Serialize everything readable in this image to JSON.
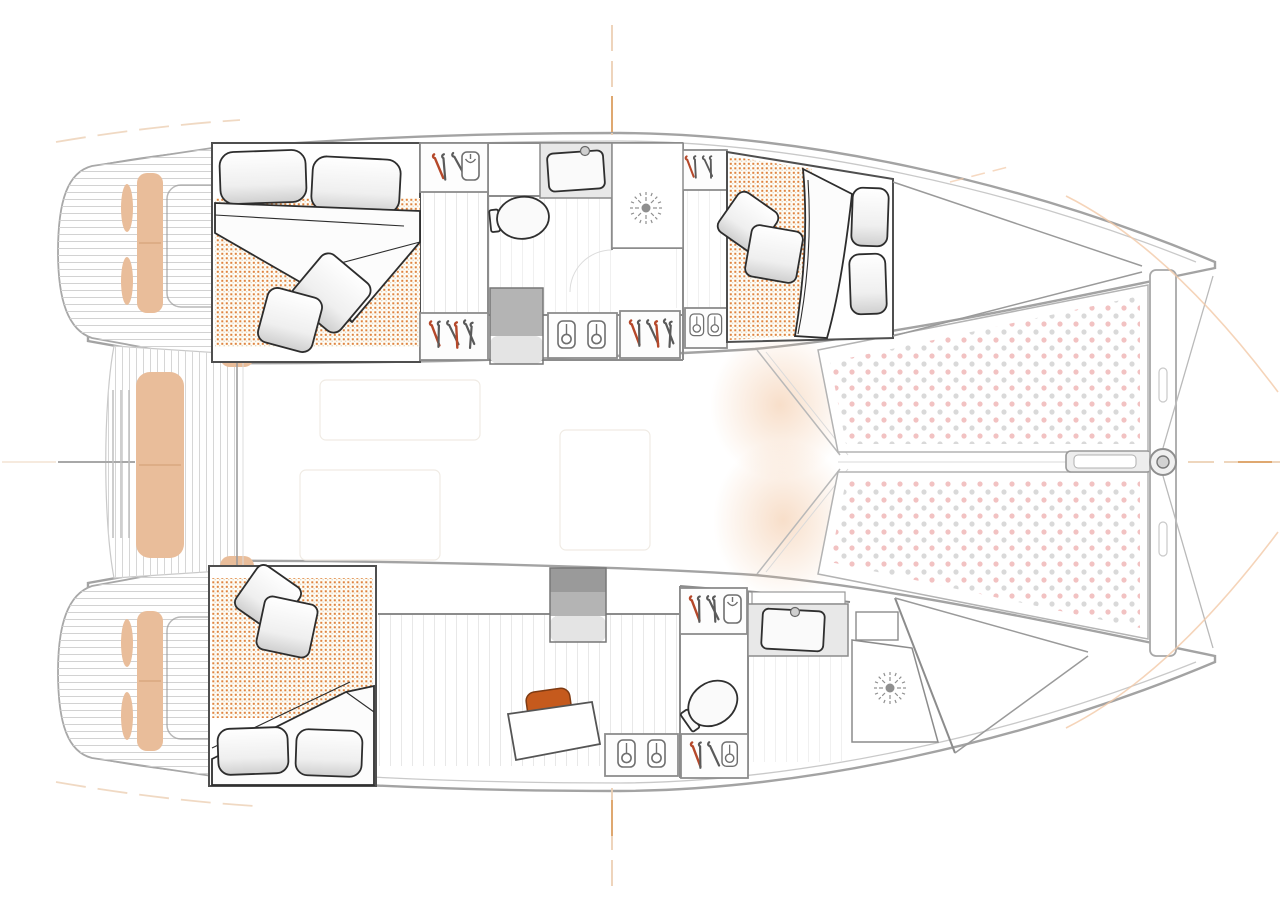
{
  "diagram": {
    "type": "floorplan",
    "subject": "catamaran interior layout, plan view",
    "orientation": {
      "bow": "right",
      "stern": "left"
    },
    "hulls": [
      {
        "name": "upper-hull",
        "rooms": [
          "aft double cabin",
          "head with shower",
          "forward double cabin",
          "forepeak"
        ]
      },
      {
        "name": "lower-hull",
        "rooms": [
          "aft double cabin",
          "desk area",
          "head with shower",
          "forepeak"
        ]
      }
    ],
    "shared_areas": [
      "port and starboard swim platforms with bench seats",
      "aft cockpit with long bench",
      "saloon (faint)",
      "twin bow trampolines",
      "forward crossbeam with bowsprit"
    ],
    "fixture_counts": {
      "double_beds": 3,
      "toilets": 2,
      "washbasins": 2,
      "showers": 2,
      "wardrobes": 7,
      "companionway_steps": 2,
      "desk_chairs": 1
    }
  },
  "colors": {
    "background": "#ffffff",
    "hull_outline": "#a3a3a3",
    "inner_line": "#c9c9c9",
    "wall": "#8c8c8c",
    "furniture_outline": "#2d2d2d",
    "bed_frame": "#4f4f4f",
    "seat_tan": "#e9bd9a",
    "seat_tan_divider": "#d9a87f",
    "accent_orange": "#c55a1d",
    "mattress_dot": "#df8440",
    "mattress_bg": "#fffdf6",
    "tramp_dot_pink": "#f2c2c2",
    "tramp_dot_gray": "#d9d9d9",
    "teak_line": "#d2d2d2",
    "plank_line": "#e4e4e4",
    "steps_dark": "#9a9a9a",
    "steps_mid": "#b4b4b4",
    "steps_light": "#e4e4e4",
    "hanger_red": "#b5482a",
    "hanger_gray": "#5a5a5a",
    "sun_icon": "#8f8f8f",
    "centerline_peach": "#ecd0b4",
    "centerline_accent": "#dfa870",
    "glow_peach": "#f2c49e"
  },
  "icons": [
    "hanger-icon",
    "garment-icon",
    "coat-hook-icon",
    "shower-rose-icon",
    "toilet-icon",
    "washbasin-icon",
    "bowsprit-fitting-icon"
  ]
}
